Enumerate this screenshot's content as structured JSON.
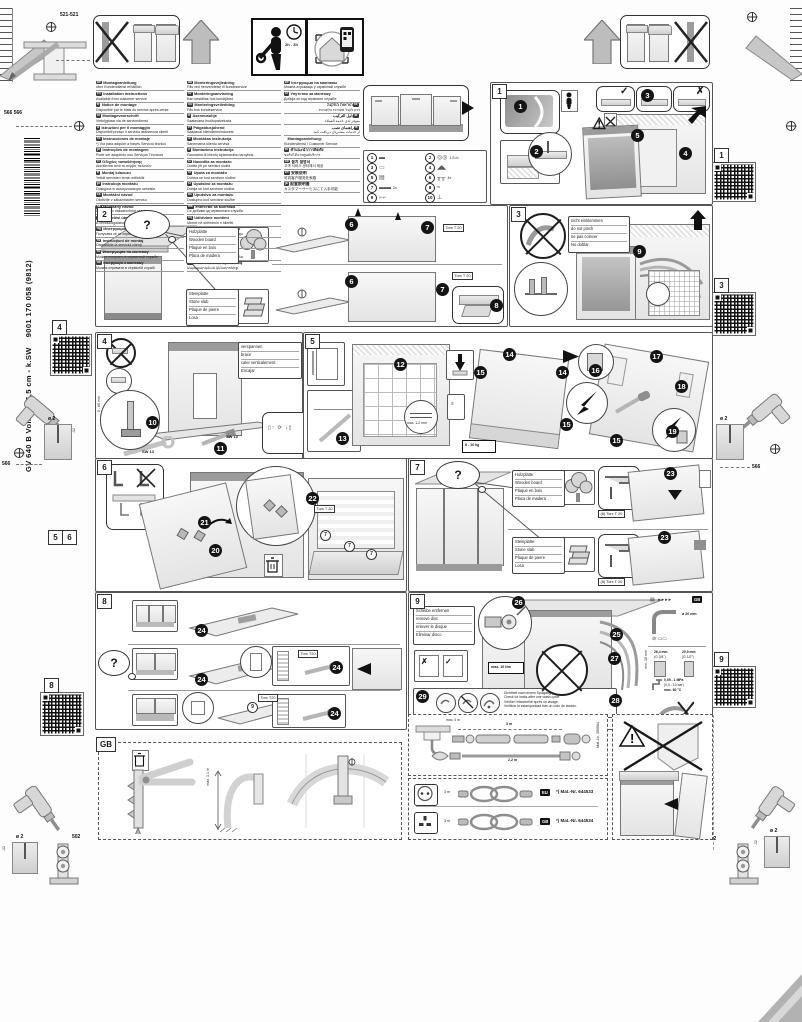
{
  "doc": {
    "side": {
      "model": "GV 640 B Voll-I - 86,5 cm - k.SW",
      "order_no": "9001 170 058 (9812)"
    },
    "dims": {
      "top": "521-521",
      "left_pair": "566 566",
      "mid_left": "566",
      "mid_right": "566",
      "bottom_left": "502",
      "bottom_right": "502",
      "drill_dia": "ø 2",
      "drill_depth": "-12"
    },
    "markers": {
      "qr1": "1",
      "qr3": "3",
      "qr4": "4",
      "qr8": "8",
      "qr9": "9",
      "m5": "5",
      "m6": "6"
    },
    "header": {
      "time": "2h - 3h"
    }
  },
  "languages": {
    "col1": [
      {
        "code": "de",
        "l1": "Montageanleitung",
        "l2": "über Kundendienst erhältlich"
      },
      {
        "code": "en",
        "l1": "Installation instructions",
        "l2": "Available from customer service"
      },
      {
        "code": "fr",
        "l1": "Notice de montage",
        "l2": "Disponible par le biais du service après-vente"
      },
      {
        "code": "nl",
        "l1": "Montagevoorschrift",
        "l2": "Verkrijgbaar via de servicedienst"
      },
      {
        "code": "it",
        "l1": "Istruzioni per il montaggio",
        "l2": "Disponibili presso il servizio assistenza clienti"
      },
      {
        "code": "es",
        "l1": "Instrucciones de montaje",
        "l2": "*) Vía para adquirir a través Servicio técnico"
      },
      {
        "code": "pt",
        "l1": "Instruções de montagem",
        "l2": "Pode ser adquirido nos Serviços Técnicos"
      },
      {
        "code": "el",
        "l1": "Οδηγίες τοποθέτησης",
        "l2": "Διατίθενται από το σέρβις πελατών"
      },
      {
        "code": "tr",
        "l1": "Montaj kılavuzu",
        "l2": "Yetkili servisten temin edilebilir"
      },
      {
        "code": "pl",
        "l1": "Instrukcja montażu",
        "l2": "Dostępna w autoryzowanym serwisie"
      },
      {
        "code": "cs",
        "l1": "Montážní návod",
        "l2": "Obdržíte v zákaznickém servisu"
      },
      {
        "code": "sk",
        "l1": "Montážny návod",
        "l2": "Dostupný v zákazníckom servise"
      },
      {
        "code": "hu",
        "l1": "Szerelési útmutató",
        "l2": "A vevőszolgálatnál szerezhető be"
      },
      {
        "code": "bg",
        "l1": "Инструкция за монтаж",
        "l2": "Получава се от сервиза"
      },
      {
        "code": "ro",
        "l1": "Instrucţiuni de montaj",
        "l2": "Disponibile la serviciul clienţi"
      },
      {
        "code": "ru",
        "l1": "Инструкция по монтажу",
        "l2": "Можно получить в сервисной службе"
      },
      {
        "code": "uk",
        "l1": "Інструкція з монтажу",
        "l2": "Можна отримати в сервісній службі"
      }
    ],
    "col2": [
      {
        "code": "da",
        "l1": "Monteringsvejledning",
        "l2": "Fås ved henvendelse til kundeservice"
      },
      {
        "code": "sv",
        "l1": "Monteringsanvisning",
        "l2": "Kan beställas hos kundtjänst"
      },
      {
        "code": "no",
        "l1": "Monteringsveiledning",
        "l2": "Fås hos kundeservice"
      },
      {
        "code": "fi",
        "l1": "Asennusohje",
        "l2": "Saatavana huoltopalvelusta"
      },
      {
        "code": "et",
        "l1": "Paigaldusjuhend",
        "l2": "Saadaval klienditeenindusest"
      },
      {
        "code": "lv",
        "l1": "Montāžas instrukcija",
        "l2": "Saņemama klientu servisā"
      },
      {
        "code": "lt",
        "l1": "Montavimo instrukcija",
        "l2": "Gaunama iš klientų aptarnavimo tarnybos"
      },
      {
        "code": "sl",
        "l1": "Navodila za montažo",
        "l2": "Dobite jih pri servisni službi"
      },
      {
        "code": "hr",
        "l1": "Uputa za montažu",
        "l2": "Dobiva se kod servisne službe"
      },
      {
        "code": "sr",
        "l1": "Uputstvo za montažu",
        "l2": "Dobija se kod servisne službe"
      },
      {
        "code": "bs",
        "l1": "Uputstvo za montažu",
        "l2": "Dostupno kod servisne službe"
      },
      {
        "code": "mk",
        "l1": "Упатство за монтажа",
        "l2": "Се добива од сервисната служба"
      },
      {
        "code": "sq",
        "l1": "Udhëzime montimi",
        "l2": "Merret në shërbimin e klientit"
      },
      {
        "code": "kk",
        "l1": "Монтаждау нұсқаулығы",
        "l2": "Сервис қызметінен алуға болады"
      },
      {
        "code": "ka",
        "l1": "მონტაჟის ინსტრუქცია",
        "l2": "მიიღება სერვის ცენტრში"
      },
      {
        "code": "az",
        "l1": "Quraşdırma təlimatı",
        "l2": "Müştəri xidmətindən əldə edilə bilər"
      },
      {
        "code": "hy",
        "l1": "Մոնտաժման հրահանգ",
        "l2": "Սպասարկման կենտրոնից"
      }
    ],
    "col3": [
      {
        "code": "be",
        "l1": "Інструкцыя па мантажы",
        "l2": "Можна атрымаць у сэрвіснай службе",
        "cls": ""
      },
      {
        "code": "sr",
        "l1": "Упутство за монтажу",
        "l2": "Добија се код сервисне службе",
        "cls": ""
      },
      {
        "code": "he",
        "l1": "הוראות התקנה",
        "l2": "ניתן לקבל משירות הלקוחות",
        "cls": "rtl"
      },
      {
        "code": "ar",
        "l1": "دليل التركيب",
        "l2": "متوفر لدى خدمة العملاء",
        "cls": "rtl"
      },
      {
        "code": "fa",
        "l1": "راهنمای نصب",
        "l2": "از خدمات مشتریان دریافت کنید",
        "cls": "rtl"
      },
      {
        "code": "",
        "l1": "Montageanleitung:",
        "l2": "Kundendienst / Customer Service",
        "cls": ""
      },
      {
        "code": "th",
        "l1": "คำแนะนำการติดตั้ง",
        "l2": "ขอรับได้จากศูนย์บริการ",
        "cls": ""
      },
      {
        "code": "ko",
        "l1": "설치 설명서",
        "l2": "고객 서비스 센터에서 제공",
        "cls": ""
      },
      {
        "code": "zh",
        "l1": "安装说明",
        "l2": "可向客户服务处索取",
        "cls": ""
      },
      {
        "code": "ja",
        "l1": "設置説明書",
        "l2": "カスタマーサービスにて入手可能",
        "cls": ""
      }
    ]
  },
  "parts": {
    "items": [
      {
        "n": "1",
        "shape": "▬",
        "qty": ""
      },
      {
        "n": "2",
        "shape": "◎◎",
        "qty": "1,5 m"
      },
      {
        "n": "3",
        "shape": "▭",
        "qty": ""
      },
      {
        "n": "4",
        "shape": "◢◣",
        "qty": ""
      },
      {
        "n": "5",
        "shape": "▤",
        "qty": ""
      },
      {
        "n": "6",
        "shape": "╥╥",
        "qty": "4x"
      },
      {
        "n": "7",
        "shape": "▬▬",
        "qty": "2x"
      },
      {
        "n": "8",
        "shape": "≈",
        "qty": ""
      },
      {
        "n": "9",
        "shape": "⌐⌐",
        "qty": ""
      },
      {
        "n": "10",
        "shape": "⊥",
        "qty": ""
      }
    ]
  },
  "steps": {
    "s1": {
      "label": "1",
      "b": [
        "1",
        "2",
        "3",
        "4",
        "5"
      ],
      "warn": "⚠"
    },
    "s2": {
      "label": "2",
      "torx": "Torx T 20",
      "wood": [
        "Holzplatte",
        "Wooden board",
        "Plaque en bois",
        "Placa de madera"
      ],
      "stone": [
        "Steinplatte",
        "Stone slab",
        "Plaque de pierre",
        "Losa"
      ],
      "b": [
        "6",
        "7",
        "8"
      ]
    },
    "s3": {
      "label": "3",
      "note": [
        "nicht einklemmen",
        "do not pinch",
        "ne pas coincer",
        "No doblar"
      ],
      "b": [
        "9"
      ]
    },
    "s4": {
      "label": "4",
      "note": [
        "verspannen",
        "brace",
        "caler verticalement",
        "Encajar"
      ],
      "range": "0 - 60 mm",
      "sw13": "SW 13",
      "sw10": "SW 10",
      "b": [
        "10",
        "11"
      ]
    },
    "s5": {
      "label": "5",
      "gap": "max. 1-2 mm",
      "weight": "8 - 10 kg",
      "b": [
        "12",
        "13",
        "14",
        "15",
        "16",
        "17",
        "18",
        "19"
      ]
    },
    "s6": {
      "label": "6",
      "torx": "Torx T 20",
      "screw": "7",
      "b": [
        "20",
        "21",
        "22"
      ]
    },
    "s7": {
      "label": "7",
      "torx": "(8) Torx T 20",
      "b": [
        "23"
      ]
    },
    "s8": {
      "label": "8",
      "torx": "Torx T20",
      "screw": "9",
      "b": [
        "24"
      ]
    },
    "s9": {
      "label": "9",
      "note": [
        "Scheibe entfernen",
        "remove disc",
        "enlever le disque",
        "Eliminar disco"
      ],
      "torque": "max. 10 Nm",
      "b": [
        "25",
        "26",
        "27",
        "28",
        "29"
      ],
      "leak": [
        "Dichtheit nach einem Spülgang prüfen.",
        "Check for leaks after one wash cycle.",
        "Vérifier l'étanchéité après un lavage.",
        "Verificar la estanqueidad tras un ciclo de lavado."
      ],
      "specs": {
        "flag": "GB",
        "drain_dia": "ø 20 mm",
        "thread_l": "26,4 mm",
        "thread_l2": "(G 3/4\")",
        "thread_r": "20,9 mm",
        "thread_r2": "(G 1/2\")",
        "min_clear": "min. 10 mm",
        "pressure": "0,05 - 1 MPa",
        "pressure2": "(0,5 - 10 bar)",
        "temp": "max. 60 °C"
      }
    },
    "gb": {
      "label": "GB",
      "hose_h": "max. 1,1 m"
    }
  },
  "bottom": {
    "ext": {
      "len_max": "max. 4 m",
      "len_top": "3 m",
      "len_bottom": "2,2 m",
      "mat": "Mat.-Nr. 350564"
    },
    "cords": {
      "rows": [
        {
          "flag": "EU",
          "len": "3 m",
          "mat": "*) Mat.-Nr. 644533"
        },
        {
          "flag": "GB",
          "len": "3 m",
          "mat": "*) Mat.-Nr. 644534"
        }
      ]
    }
  }
}
